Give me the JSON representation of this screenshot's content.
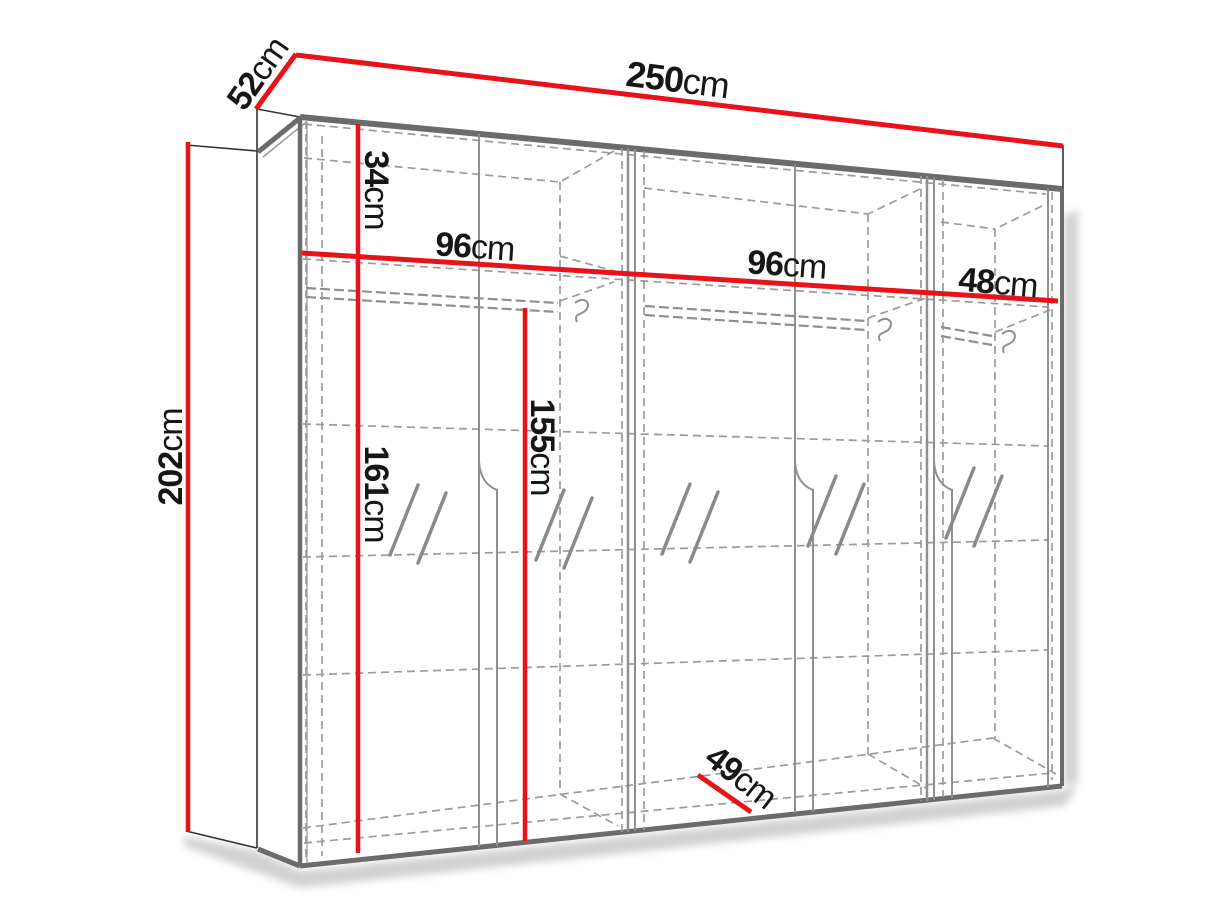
{
  "diagram": {
    "name": "wardrobe-dimension-diagram",
    "unit_suffix": "cm",
    "dimensions": {
      "total_width": {
        "value": "250",
        "unit": "cm"
      },
      "side_depth": {
        "value": "52",
        "unit": "cm"
      },
      "total_height": {
        "value": "202",
        "unit": "cm"
      },
      "top_compartment_height": {
        "value": "34",
        "unit": "cm"
      },
      "left_section_width": {
        "value": "96",
        "unit": "cm"
      },
      "middle_section_width": {
        "value": "96",
        "unit": "cm"
      },
      "right_section_width": {
        "value": "48",
        "unit": "cm"
      },
      "left_interior_height": {
        "value": "161",
        "unit": "cm"
      },
      "hanging_space_height": {
        "value": "155",
        "unit": "cm"
      },
      "interior_depth": {
        "value": "49",
        "unit": "cm"
      }
    },
    "colors": {
      "dimension_line": "#e8131a",
      "edge": "#6b6b6b",
      "interior_line": "#8f8f8f",
      "dashed_line": "#9b9b9b",
      "label_text": "#161616",
      "background": "#ffffff",
      "shadow": "#b5b5b5"
    },
    "symbols": {
      "mirror_mark": "double-slash-glass-icon",
      "rail_hook": "hanger-hook-icon"
    }
  }
}
